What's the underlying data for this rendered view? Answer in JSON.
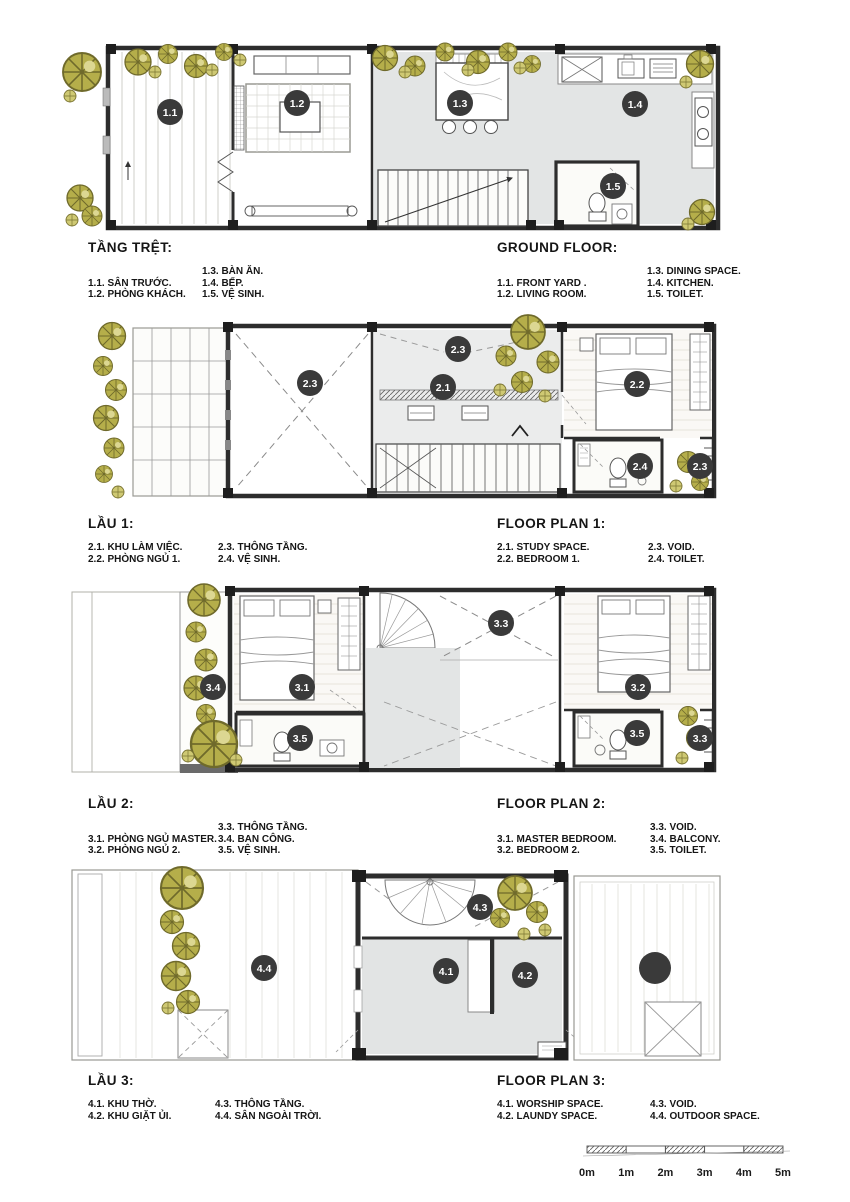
{
  "colors": {
    "label_circle": "#3a3a3a",
    "wall": "#2d2d2d",
    "floor_grey": "#e3e5e5",
    "tree_olive": "#b5ae4a",
    "tree_light": "#cfc973"
  },
  "floors": [
    {
      "title_vi": "TẦNG TRỆT:",
      "title_en": "GROUND FLOOR:",
      "legend_vi": {
        "col1": [
          "1.1. SÂN TRƯỚC.",
          "1.2. PHÒNG KHÁCH."
        ],
        "col2": [
          "1.3. BÀN ĂN.",
          "1.4. BẾP.",
          "1.5. VỆ SINH."
        ]
      },
      "legend_en": {
        "col1": [
          "1.1. FRONT YARD .",
          "1.2. LIVING ROOM."
        ],
        "col2": [
          "1.3. DINING SPACE.",
          "1.4. KITCHEN.",
          "1.5. TOILET."
        ]
      },
      "labels": [
        {
          "t": "1.1",
          "x": 170,
          "y": 112
        },
        {
          "t": "1.2",
          "x": 297,
          "y": 103
        },
        {
          "t": "1.3",
          "x": 460,
          "y": 103
        },
        {
          "t": "1.4",
          "x": 635,
          "y": 104
        },
        {
          "t": "1.5",
          "x": 613,
          "y": 186
        }
      ]
    },
    {
      "title_vi": "LẦU 1:",
      "title_en": "FLOOR PLAN 1:",
      "legend_vi": {
        "col1": [
          "2.1. KHU LÀM VIỆC.",
          "2.2. PHÒNG NGỦ 1."
        ],
        "col2": [
          "2.3. THÔNG TẦNG.",
          "2.4. VỆ SINH."
        ]
      },
      "legend_en": {
        "col1": [
          "2.1. STUDY SPACE.",
          "2.2. BEDROOM 1."
        ],
        "col2": [
          "2.3. VOID.",
          "2.4. TOILET."
        ]
      },
      "labels": [
        {
          "t": "2.3",
          "x": 310,
          "y": 383
        },
        {
          "t": "2.3",
          "x": 458,
          "y": 349
        },
        {
          "t": "2.1",
          "x": 443,
          "y": 387
        },
        {
          "t": "2.2",
          "x": 637,
          "y": 384
        },
        {
          "t": "2.4",
          "x": 640,
          "y": 466
        },
        {
          "t": "2.3",
          "x": 700,
          "y": 466
        }
      ]
    },
    {
      "title_vi": "LẦU 2:",
      "title_en": "FLOOR PLAN 2:",
      "legend_vi": {
        "col1": [
          "3.1. PHÒNG NGỦ MASTER.",
          "3.2. PHÒNG NGỦ 2."
        ],
        "col2": [
          "3.3. THÔNG TẦNG.",
          "3.4. BAN CÔNG.",
          "3.5. VỆ SINH."
        ]
      },
      "legend_en": {
        "col1": [
          "3.1. MASTER BEDROOM.",
          "3.2. BEDROOM 2."
        ],
        "col2": [
          "3.3. VOID.",
          "3.4. BALCONY.",
          "3.5. TOILET."
        ]
      },
      "labels": [
        {
          "t": "3.4",
          "x": 213,
          "y": 687
        },
        {
          "t": "3.1",
          "x": 302,
          "y": 687
        },
        {
          "t": "3.3",
          "x": 501,
          "y": 623
        },
        {
          "t": "3.2",
          "x": 638,
          "y": 687
        },
        {
          "t": "3.5",
          "x": 300,
          "y": 738
        },
        {
          "t": "3.5",
          "x": 637,
          "y": 733
        },
        {
          "t": "3.3",
          "x": 700,
          "y": 738
        }
      ]
    },
    {
      "title_vi": "LẦU 3:",
      "title_en": "FLOOR PLAN 3:",
      "legend_vi": {
        "col1": [
          "4.1. KHU THỜ.",
          "4.2. KHU GIẶT ỦI."
        ],
        "col2": [
          "4.3. THÔNG TẦNG.",
          "4.4. SÂN NGOÀI TRỜI."
        ]
      },
      "legend_en": {
        "col1": [
          "4.1. WORSHIP SPACE.",
          "4.2. LAUNDY SPACE."
        ],
        "col2": [
          "4.3. VOID.",
          "4.4. OUTDOOR SPACE."
        ]
      },
      "labels": [
        {
          "t": "4.4",
          "x": 264,
          "y": 968
        },
        {
          "t": "4.3",
          "x": 480,
          "y": 907
        },
        {
          "t": "4.1",
          "x": 446,
          "y": 971
        },
        {
          "t": "4.2",
          "x": 525,
          "y": 975
        }
      ]
    }
  ],
  "scale_bar": {
    "ticks": [
      "0m",
      "1m",
      "2m",
      "3m",
      "4m",
      "5m"
    ]
  }
}
